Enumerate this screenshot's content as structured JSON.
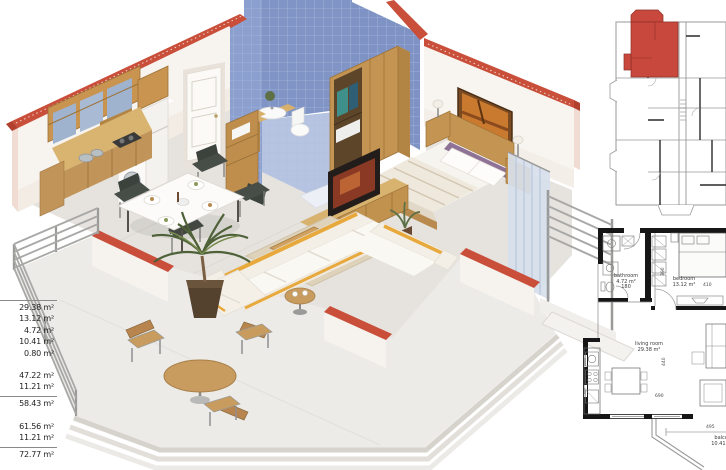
{
  "title": "3D isometric apartment floor plan with 2D building and unit plans",
  "measurements": {
    "rooms": [
      "29.38 m²",
      "13.12 m²",
      "4.72 m²",
      "10.41 m²",
      "0.80 m²"
    ],
    "net": [
      "47.22 m²",
      "11.21 m²"
    ],
    "net_total": "58.43 m²",
    "gross": [
      "61.56 m²",
      "11.21 m²"
    ],
    "gross_total": "72.77 m²"
  },
  "detail_plan": {
    "bathroom": {
      "name": "bathroom",
      "area": "4.72 m²",
      "dim": "180"
    },
    "bedroom": {
      "name": "bedroom",
      "area": "13.12 m²",
      "dim": "410"
    },
    "living": {
      "name": "living room",
      "area": "29.38 m²"
    },
    "balcony": {
      "name": "balcony",
      "area": "10.41 m²",
      "dim": "495"
    },
    "dims": {
      "closet": "390",
      "living_width": "440",
      "living_length": "690"
    }
  },
  "colors": {
    "highlight_unit": "#c9483d",
    "wall_cap_brick": "#c94f3b",
    "bathroom_tile": "#8ba0ce",
    "wood": "#c89a58",
    "sofa_accent": "#e8a93c",
    "plan_wall": "#161616"
  }
}
